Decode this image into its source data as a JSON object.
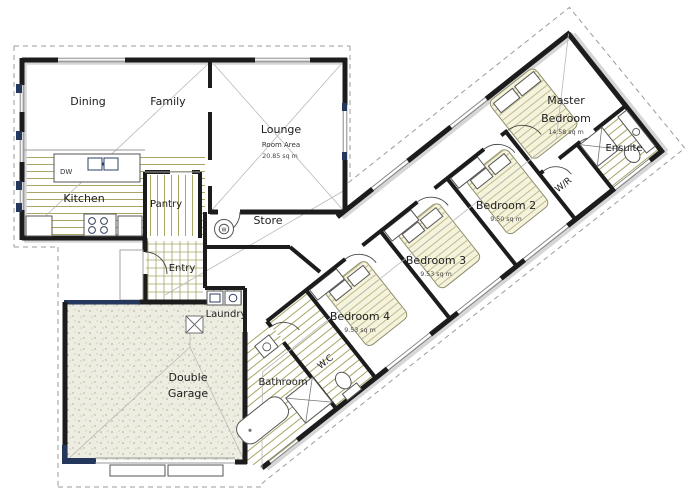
{
  "plan": {
    "rooms": {
      "dining": {
        "label": "Dining"
      },
      "family": {
        "label": "Family"
      },
      "lounge": {
        "label": "Lounge",
        "sub": "Room Area",
        "area": "20.85 sq m"
      },
      "kitchen": {
        "label": "Kitchen"
      },
      "pantry": {
        "label": "Pantry"
      },
      "store": {
        "label": "Store"
      },
      "entry": {
        "label": "Entry"
      },
      "laundry": {
        "label": "Laundry"
      },
      "garage": {
        "label_line1": "Double",
        "label_line2": "Garage"
      },
      "bathroom": {
        "label": "Bathroom"
      },
      "wc": {
        "label": "W.C"
      },
      "bedroom4": {
        "label": "Bedroom 4",
        "area": "9.53 sq m"
      },
      "bedroom3": {
        "label": "Bedroom 3",
        "area": "9.53 sq m"
      },
      "bedroom2": {
        "label": "Bedroom 2",
        "area": "9.50 sq m"
      },
      "master": {
        "label_line1": "Master",
        "label_line2": "Bedroom",
        "area": "14.58 sq m"
      },
      "ensuite": {
        "label": "Ensuite"
      },
      "wr": {
        "label": "W/R"
      }
    },
    "fixtures": {
      "dishwasher_label": "DW",
      "water_heater_label": "W"
    },
    "colors": {
      "wall": "#1c1c1c",
      "hatch_olive": "#a8a565",
      "navy_accent": "#25375c",
      "roof_dash": "#9b9b9b",
      "bed_fill": "#f6f3dd",
      "garage_stipple": "#a9a692",
      "wall_shadow": "#d6d6d6"
    }
  }
}
